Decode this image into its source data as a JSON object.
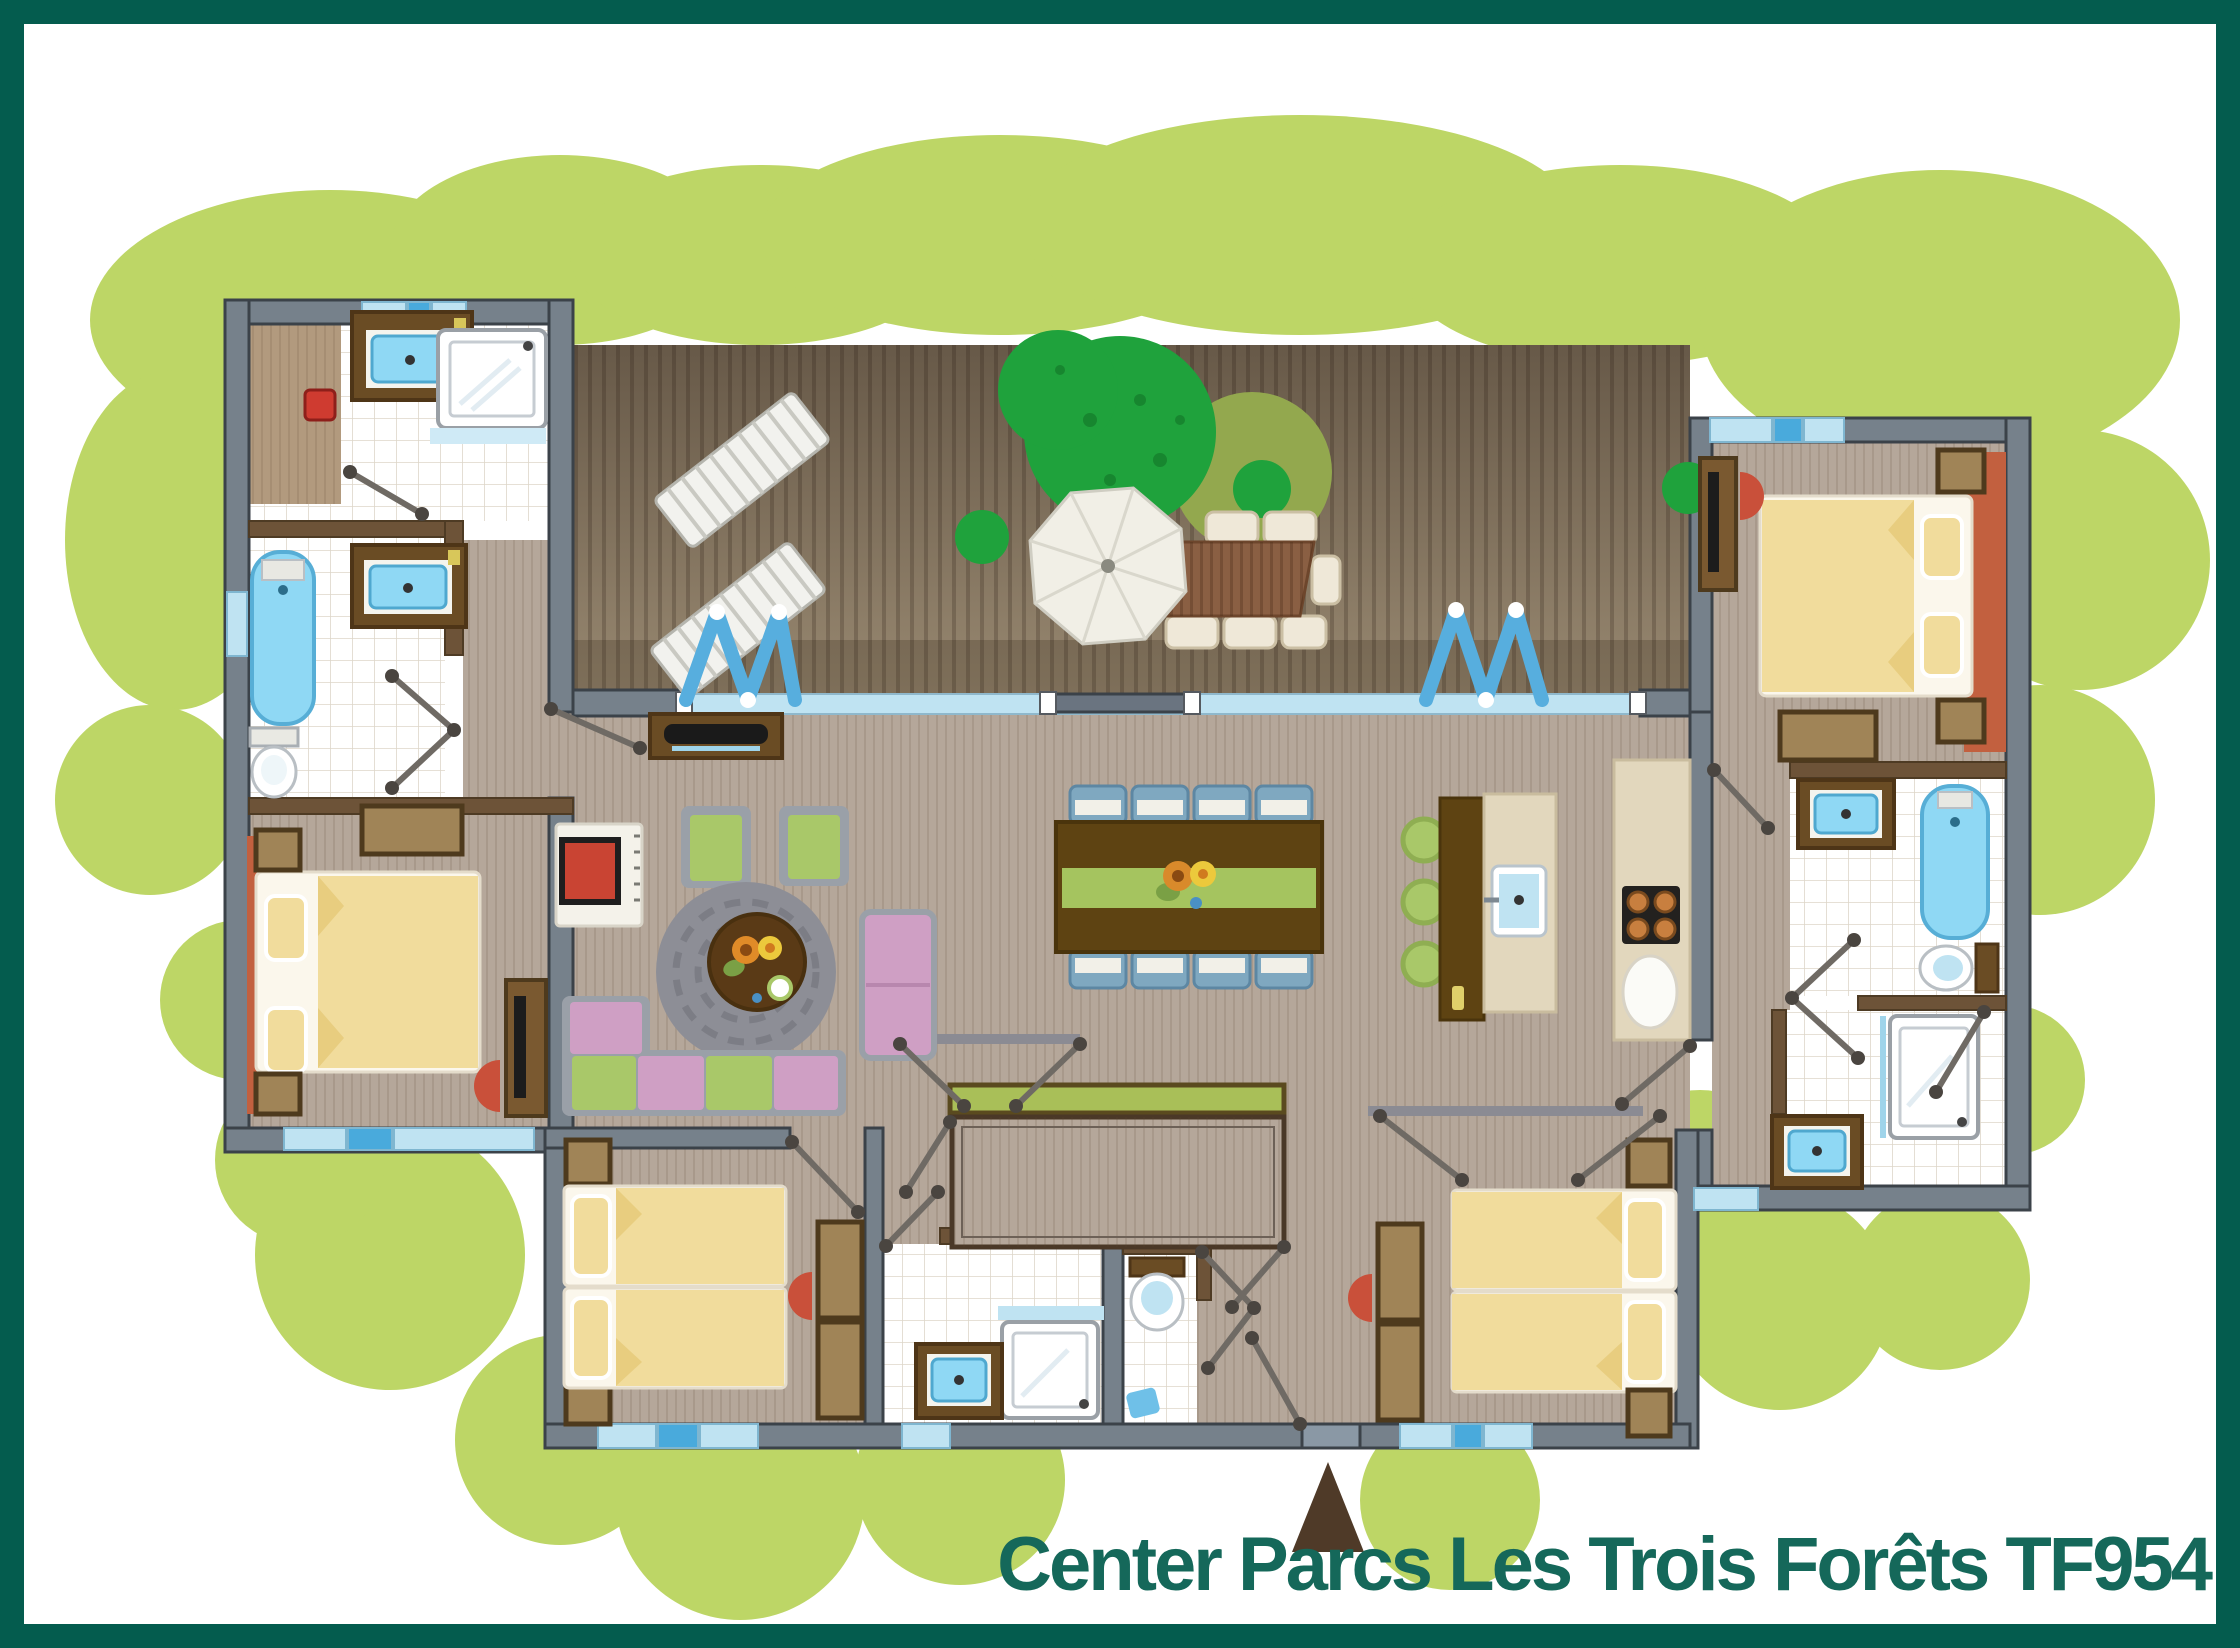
{
  "title": {
    "text": "Center Parcs Les Trois Forêts TF954",
    "color": "#15685a"
  },
  "frame": {
    "border_color": "#045c4e",
    "background": "#ffffff"
  },
  "entrance": {
    "marker": "triangle-up",
    "color": "#4f3a28"
  },
  "palette": {
    "garden_bush": "#bdd666",
    "tree": "#1fa23c",
    "tree_shadow": "#93a84e",
    "deck_wood_dark": "#6b5d4b",
    "deck_wood_light": "#97876f",
    "interior_wood": "#b5a79a",
    "wall_gray": "#76818b",
    "wall_outline": "#3b4249",
    "partition_brown": "#6d5338",
    "tile_white": "#ffffff",
    "tile_grid": "#ddd6c9",
    "window_light_blue": "#bfe3f2",
    "window_accent_blue": "#49aadc",
    "fixture_blue": "#8fd8f4",
    "vanity_brown": "#6a4c24",
    "bed_duvet": "#f1dc9c",
    "bed_sheet": "#fbf7ec",
    "nightstand": "#a08457",
    "rug_terracotta": "#c2603f",
    "sofa_pink": "#cf9fc4",
    "sofa_green": "#a9c869",
    "table_dark_brown": "#5e4312",
    "runner_green": "#a5c45f",
    "chair_blue": "#7fa8c0",
    "stove_red": "#c94433",
    "accordion_door_blue": "#57aede",
    "kitchen_cream": "#e2d7bd",
    "burner_orange": "#c87f3f"
  },
  "floorplan": {
    "type": "holiday-cottage-top-view",
    "terrace": {
      "features": [
        "wood-deck",
        "two-sun-loungers",
        "large-tree",
        "three-small-bushes",
        "outdoor-dining-table-with-chairs",
        "white-parasol",
        "two-blue-folding-doors"
      ]
    },
    "rooms": [
      {
        "name": "bathroom-top-left",
        "features": [
          "washbasin",
          "shower-cabin",
          "red-heater",
          "wood-nook"
        ]
      },
      {
        "name": "bathroom-left-2",
        "features": [
          "bathtub",
          "washbasin",
          "toilet"
        ]
      },
      {
        "name": "bedroom-left",
        "features": [
          "double-bed",
          "two-nightstands",
          "dresser",
          "tv-cabinet",
          "red-chair",
          "terracotta-rug"
        ]
      },
      {
        "name": "living-room",
        "features": [
          "tv-cabinet",
          "wood-stove",
          "two-green-armchairs",
          "round-rug",
          "round-coffee-table",
          "pink-chaise",
          "l-shaped-sofa"
        ]
      },
      {
        "name": "dining-area",
        "features": [
          "dining-table-8-blue-chairs",
          "green-table-runner",
          "flower-centerpiece"
        ]
      },
      {
        "name": "kitchen",
        "features": [
          "island-with-sink",
          "three-green-stools",
          "counter",
          "four-burner-stove"
        ]
      },
      {
        "name": "bedroom-top-right",
        "features": [
          "double-bed",
          "two-nightstands",
          "tv-cabinet",
          "red-chair",
          "dresser",
          "terracotta-rug"
        ]
      },
      {
        "name": "bathroom-right",
        "features": [
          "washbasin",
          "bathtub",
          "toilet"
        ]
      },
      {
        "name": "shower-room-right",
        "features": [
          "shower-cabin",
          "washbasin"
        ]
      },
      {
        "name": "bedroom-bottom-left",
        "features": [
          "twin-beds",
          "two-nightstands",
          "wardrobe",
          "red-chair"
        ]
      },
      {
        "name": "shower-room-center",
        "features": [
          "shower-cabin",
          "washbasin"
        ]
      },
      {
        "name": "wc-center",
        "features": [
          "toilet",
          "small-basin"
        ]
      },
      {
        "name": "storage-room-center",
        "features": [
          "empty-outlined-room",
          "green-sideboard"
        ]
      },
      {
        "name": "bedroom-bottom-right",
        "features": [
          "twin-beds",
          "two-nightstands",
          "wardrobe",
          "red-chair",
          "double-entry-doors"
        ]
      }
    ]
  }
}
